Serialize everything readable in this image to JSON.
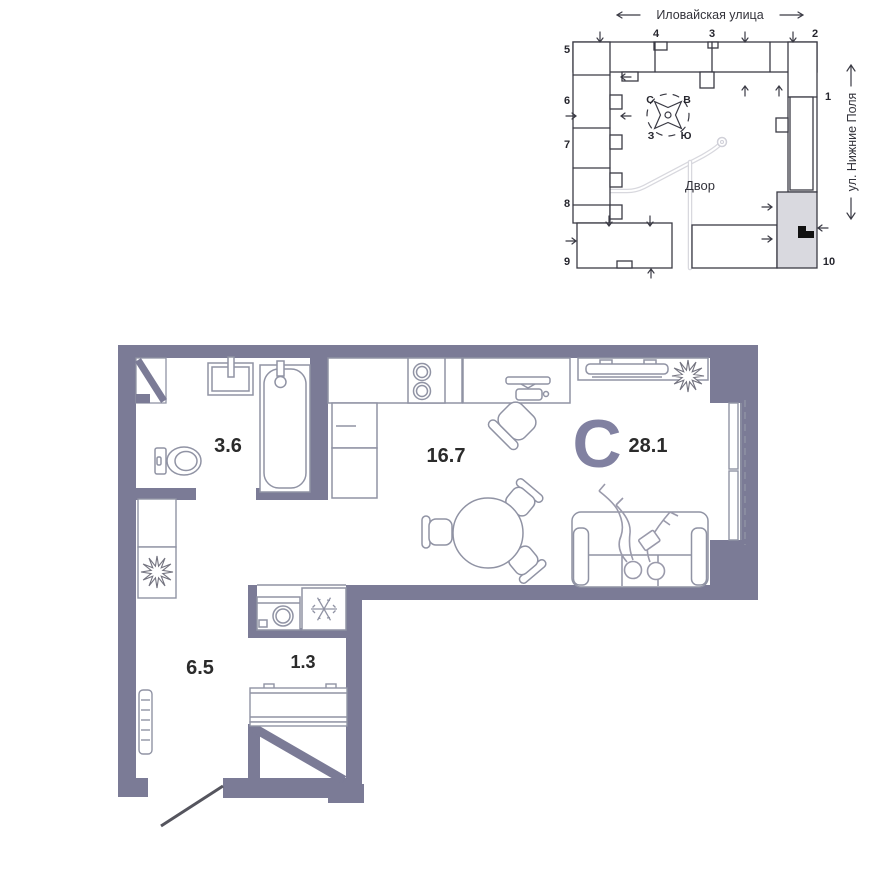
{
  "floorplan": {
    "type_letter": "С",
    "total_area": "28.1",
    "rooms": [
      {
        "name": "bathroom",
        "area": "3.6"
      },
      {
        "name": "kitchen-living",
        "area": "16.7"
      },
      {
        "name": "hallway",
        "area": "6.5"
      },
      {
        "name": "wardrobe",
        "area": "1.3"
      }
    ],
    "icons": [
      "bathtub-icon",
      "toilet-icon",
      "sink-icon",
      "stove-icon",
      "kitchen-cabinet-icon",
      "desk-icon",
      "office-chair-icon",
      "tv-console-icon",
      "round-table-icon",
      "dining-chair-icon",
      "sofa-icon",
      "people-lounging-icon",
      "washing-machine-icon",
      "fridge-snowflake-icon",
      "plant-icon",
      "radiator-icon",
      "wardrobe-diagonal-icon",
      "vent-shaft-icon",
      "entry-door-swing-icon",
      "window-icon"
    ]
  },
  "sitemap": {
    "street_top": "Иловайская улица",
    "street_right": "ул. Нижние Поля",
    "courtyard": "Двор",
    "compass": {
      "n": "С",
      "e": "В",
      "w": "З",
      "s": "Ю"
    },
    "sections": [
      "1",
      "2",
      "3",
      "4",
      "5",
      "6",
      "7",
      "8",
      "9",
      "10"
    ],
    "icons": [
      "compass-rose-icon",
      "driveway-path-icon",
      "unit-marker-icon",
      "entrance-arrow-icon"
    ]
  },
  "colors": {
    "wall": "#7b7b96",
    "furniture_line": "#9093a4",
    "people_line": "#9a9aab",
    "label_text": "#2b2b2b",
    "type_letter": "#8181a1",
    "minimap_line": "#3b3b45",
    "highlighted_section": "#d9d9df",
    "unit_marker": "#111111",
    "driveway_path": "#d8d8de",
    "background": "#ffffff"
  }
}
